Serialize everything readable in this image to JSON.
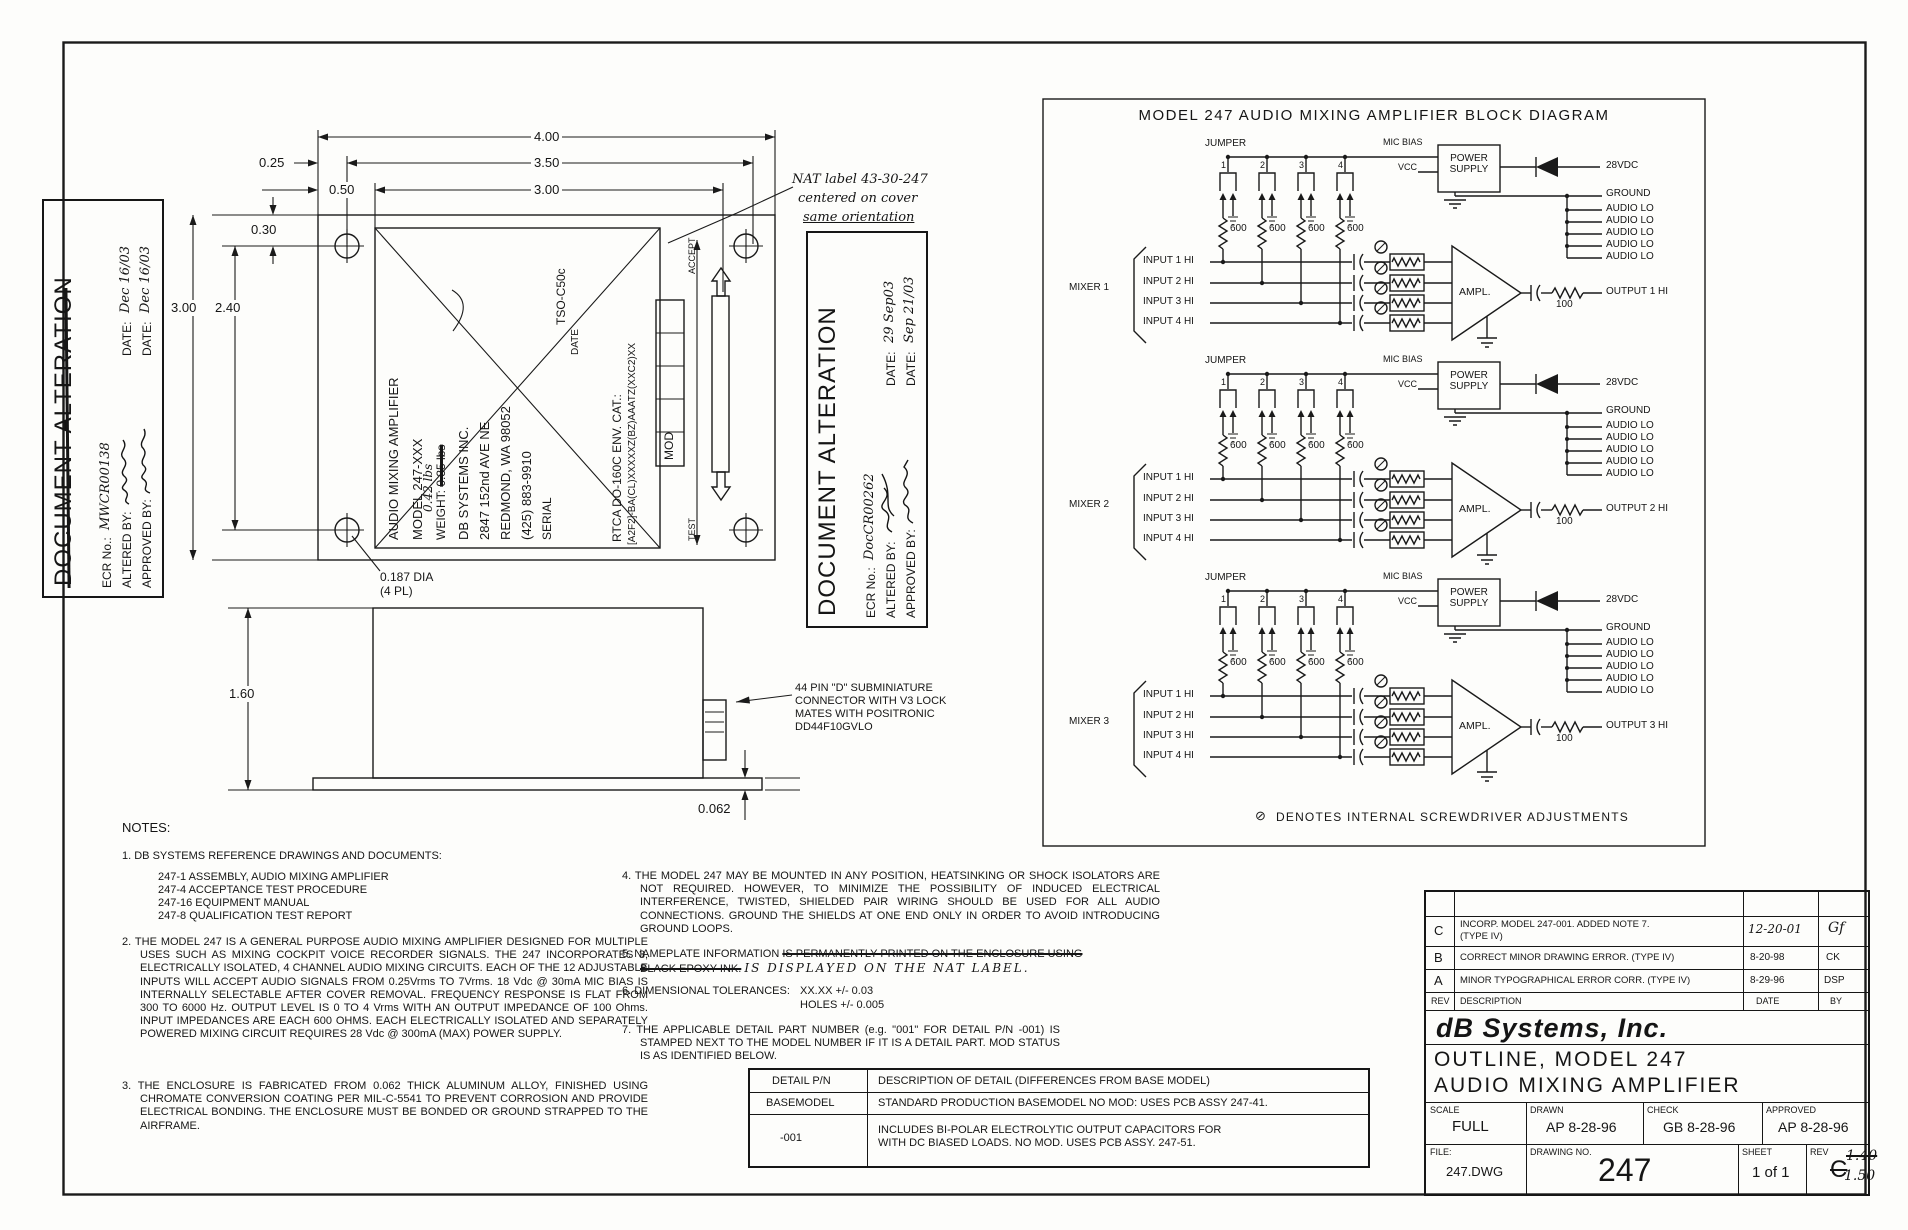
{
  "stamps": [
    {
      "title": "DOCUMENT ALTERATION",
      "ecr_label": "ECR No.:",
      "ecr": "MWCR00138",
      "altered_label": "ALTERED BY:",
      "approved_label": "APPROVED BY:",
      "date_label": "DATE:",
      "date_altered": "Dec 16/03",
      "date_approved": "Dec 16/03"
    },
    {
      "title": "DOCUMENT ALTERATION",
      "ecr_label": "ECR No.:",
      "ecr": "DocCR00262",
      "altered_label": "ALTERED BY:",
      "approved_label": "APPROVED BY:",
      "date_label": "DATE:",
      "date_altered": "29 Sep03",
      "date_approved": "Sep 21/03"
    }
  ],
  "nat_note": {
    "l1": "NAT label 43-30-247",
    "l2": "centered on cover",
    "l3": "same orientation"
  },
  "top_view": {
    "dim_400": "4.00",
    "dim_350": "3.50",
    "dim_300w": "3.00",
    "dim_025": "0.25",
    "dim_050": "0.50",
    "dim_030": "0.30",
    "dim_300h": "3.00",
    "dim_240": "2.40",
    "hole_dia": "0.187 DIA",
    "hole_qty": "(4 PL)",
    "accept": "ACCEPT",
    "test": "TEST",
    "plate": {
      "l1": "AUDIO MIXING AMPLIFIER",
      "l2": "MODEL 247-XXX",
      "weight_label": "WEIGHT:",
      "weight_struck": "0.35 lbs",
      "weight_hand": "0.42 lbs",
      "l4": "DB SYSTEMS INC.",
      "l5": "2847 152nd AVE NE",
      "l6": "REDMOND, WA 98052",
      "l7": "(425) 883-9910",
      "serial": "SERIAL",
      "tso": "TSO-C50c",
      "date": "DATE",
      "env1": "RTCA DO-160C ENV. CAT.:",
      "env2": "[A2F2]-BA(CL)XXXXXZ(BZ)AAATZ(XXC2)XX",
      "mod": "MOD"
    }
  },
  "side_view": {
    "dim_160": "1.60",
    "dim_062": "0.062",
    "conn": {
      "l1": "44 PIN \"D\" SUBMINIATURE",
      "l2": "CONNECTOR WITH V3 LOCK",
      "l3": "MATES WITH POSITRONIC",
      "l4": "DD44F10GVLO"
    }
  },
  "block": {
    "title": "MODEL 247 AUDIO MIXING AMPLIFIER BLOCK DIAGRAM",
    "labels": {
      "jumper": "JUMPER",
      "j1": "1",
      "j2": "2",
      "j3": "3",
      "j4": "4",
      "r600": "600",
      "mic_bias": "MIC BIAS",
      "vcc": "VCC",
      "ps1": "POWER",
      "ps2": "SUPPLY",
      "v28": "28VDC",
      "ground": "GROUND",
      "audio_lo": "AUDIO LO",
      "in1": "INPUT 1 HI",
      "in2": "INPUT 2 HI",
      "in3": "INPUT 3 HI",
      "in4": "INPUT 4 HI",
      "ampl": "AMPL.",
      "r100": "100"
    },
    "mixers": [
      {
        "name": "MIXER 1",
        "output": "OUTPUT 1 HI"
      },
      {
        "name": "MIXER 2",
        "output": "OUTPUT 2 HI"
      },
      {
        "name": "MIXER 3",
        "output": "OUTPUT 3 HI"
      }
    ],
    "denotes_symbol": "⊘",
    "denotes": "DENOTES INTERNAL SCREWDRIVER ADJUSTMENTS"
  },
  "notes": {
    "heading": "NOTES:",
    "n1_head": "1. DB SYSTEMS REFERENCE DRAWINGS AND DOCUMENTS:",
    "n1_items": [
      "247-1 ASSEMBLY, AUDIO MIXING AMPLIFIER",
      "247-4 ACCEPTANCE TEST PROCEDURE",
      "247-16 EQUIPMENT MANUAL",
      "247-8 QUALIFICATION TEST REPORT"
    ],
    "n2": "2. THE MODEL 247 IS A GENERAL PURPOSE AUDIO MIXING AMPLIFIER DESIGNED FOR MULTIPLE USES SUCH AS MIXING COCKPIT VOICE RECORDER SIGNALS.  THE 247 INCORPORATES 3, ELECTRICALLY ISOLATED, 4 CHANNEL AUDIO MIXING CIRCUITS. EACH OF THE 12 ADJUSTABLE INPUTS WILL ACCEPT AUDIO SIGNALS FROM 0.25Vrms TO 7Vrms.  18 Vdc @ 30mA MIC BIAS IS INTERNALLY SELECTABLE AFTER COVER REMOVAL.  FREQUENCY RESPONSE IS FLAT FROM 300 TO 6000 Hz.  OUTPUT LEVEL IS 0 TO 4 Vrms WITH AN OUTPUT IMPEDANCE OF 100 Ohms.  INPUT IMPEDANCES ARE EACH 600 OHMS.  EACH ELECTRICALLY ISOLATED AND SEPARATELY POWERED MIXING CIRCUIT REQUIRES 28 Vdc @ 300mA (MAX) POWER SUPPLY.",
    "n3": "3. THE ENCLOSURE IS FABRICATED FROM 0.062 THICK ALUMINUM ALLOY, FINISHED USING CHROMATE CONVERSION COATING PER MIL-C-5541 TO PREVENT CORROSION AND PROVIDE ELECTRICAL BONDING.  THE ENCLOSURE MUST BE BONDED OR GROUND STRAPPED TO THE AIRFRAME.",
    "n4": "4. THE MODEL 247 MAY BE MOUNTED IN ANY POSITION, HEATSINKING OR SHOCK ISOLATORS ARE NOT REQUIRED.  HOWEVER, TO MINIMIZE THE POSSIBILITY OF INDUCED ELECTRICAL INTERFERENCE, TWISTED, SHIELDED PAIR WIRING SHOULD BE USED FOR ALL AUDIO CONNECTIONS.  GROUND THE SHIELDS AT ONE END ONLY IN ORDER TO AVOID INTRODUCING GROUND LOOPS.",
    "n5_pre": "5. NAMEPLATE INFORMATION ",
    "n5_struck1": "IS PERMANENTLY PRINTED ON THE ENCLOSURE USING",
    "n5_struck2": "BLACK EPOXY INK.",
    "n5_hand": "IS DISPLAYED ON THE NAT LABEL.",
    "n6_head": "6. DIMENSIONAL TOLERANCES:",
    "n6_a": "XX.XX +/- 0.03",
    "n6_b": "HOLES +/- 0.005",
    "n7": "7. THE APPLICABLE DETAIL PART NUMBER (e.g. \"001\" FOR DETAIL P/N -001) IS STAMPED NEXT TO THE MODEL NUMBER IF IT IS A DETAIL PART.  MOD STATUS IS AS IDENTIFIED BELOW."
  },
  "detail_table": {
    "h_pn": "DETAIL P/N",
    "h_desc": "DESCRIPTION OF DETAIL (DIFFERENCES FROM BASE MODEL)",
    "rows": [
      {
        "pn": "BASEMODEL",
        "desc": "STANDARD PRODUCTION BASEMODEL NO MOD: USES PCB ASSY 247-41."
      },
      {
        "pn": "-001",
        "desc": "INCLUDES BI-POLAR ELECTROLYTIC OUTPUT CAPACITORS FOR\nWITH DC BIASED LOADS.  NO MOD.  USES PCB ASSY. 247-51."
      }
    ]
  },
  "title_block": {
    "revisions": [
      {
        "rev": "C",
        "desc": "INCORP. MODEL 247-001.  ADDED NOTE 7.",
        "desc2": "(TYPE IV)",
        "date": "12-20-01",
        "by": "Gf"
      },
      {
        "rev": "B",
        "desc": "CORRECT MINOR DRAWING ERROR. (TYPE IV)",
        "desc2": "",
        "date": "8-20-98",
        "by": "CK"
      },
      {
        "rev": "A",
        "desc": "MINOR TYPOGRAPHICAL ERROR CORR. (TYPE IV)",
        "desc2": "",
        "date": "8-29-96",
        "by": "DSP"
      }
    ],
    "rev_header": {
      "rev": "REV",
      "desc": "DESCRIPTION",
      "date": "DATE",
      "by": "BY"
    },
    "company": "dB Systems, Inc.",
    "title1": "OUTLINE, MODEL 247",
    "title2": "AUDIO MIXING AMPLIFIER",
    "scale_label": "SCALE",
    "scale": "FULL",
    "drawn_label": "DRAWN",
    "drawn": "AP 8-28-96",
    "check_label": "CHECK",
    "check": "GB 8-28-96",
    "approved_label": "APPROVED",
    "approved": "AP 8-28-96",
    "file_label": "FILE:",
    "file": "247.DWG",
    "dwg_label": "DRAWING NO.",
    "dwg_no": "247",
    "sheet_label": "SHEET",
    "sheet": "1 of 1",
    "rev_label": "REV",
    "rev_value": "C",
    "rev_hand_old": "1.40",
    "rev_hand_new": "1.50"
  }
}
